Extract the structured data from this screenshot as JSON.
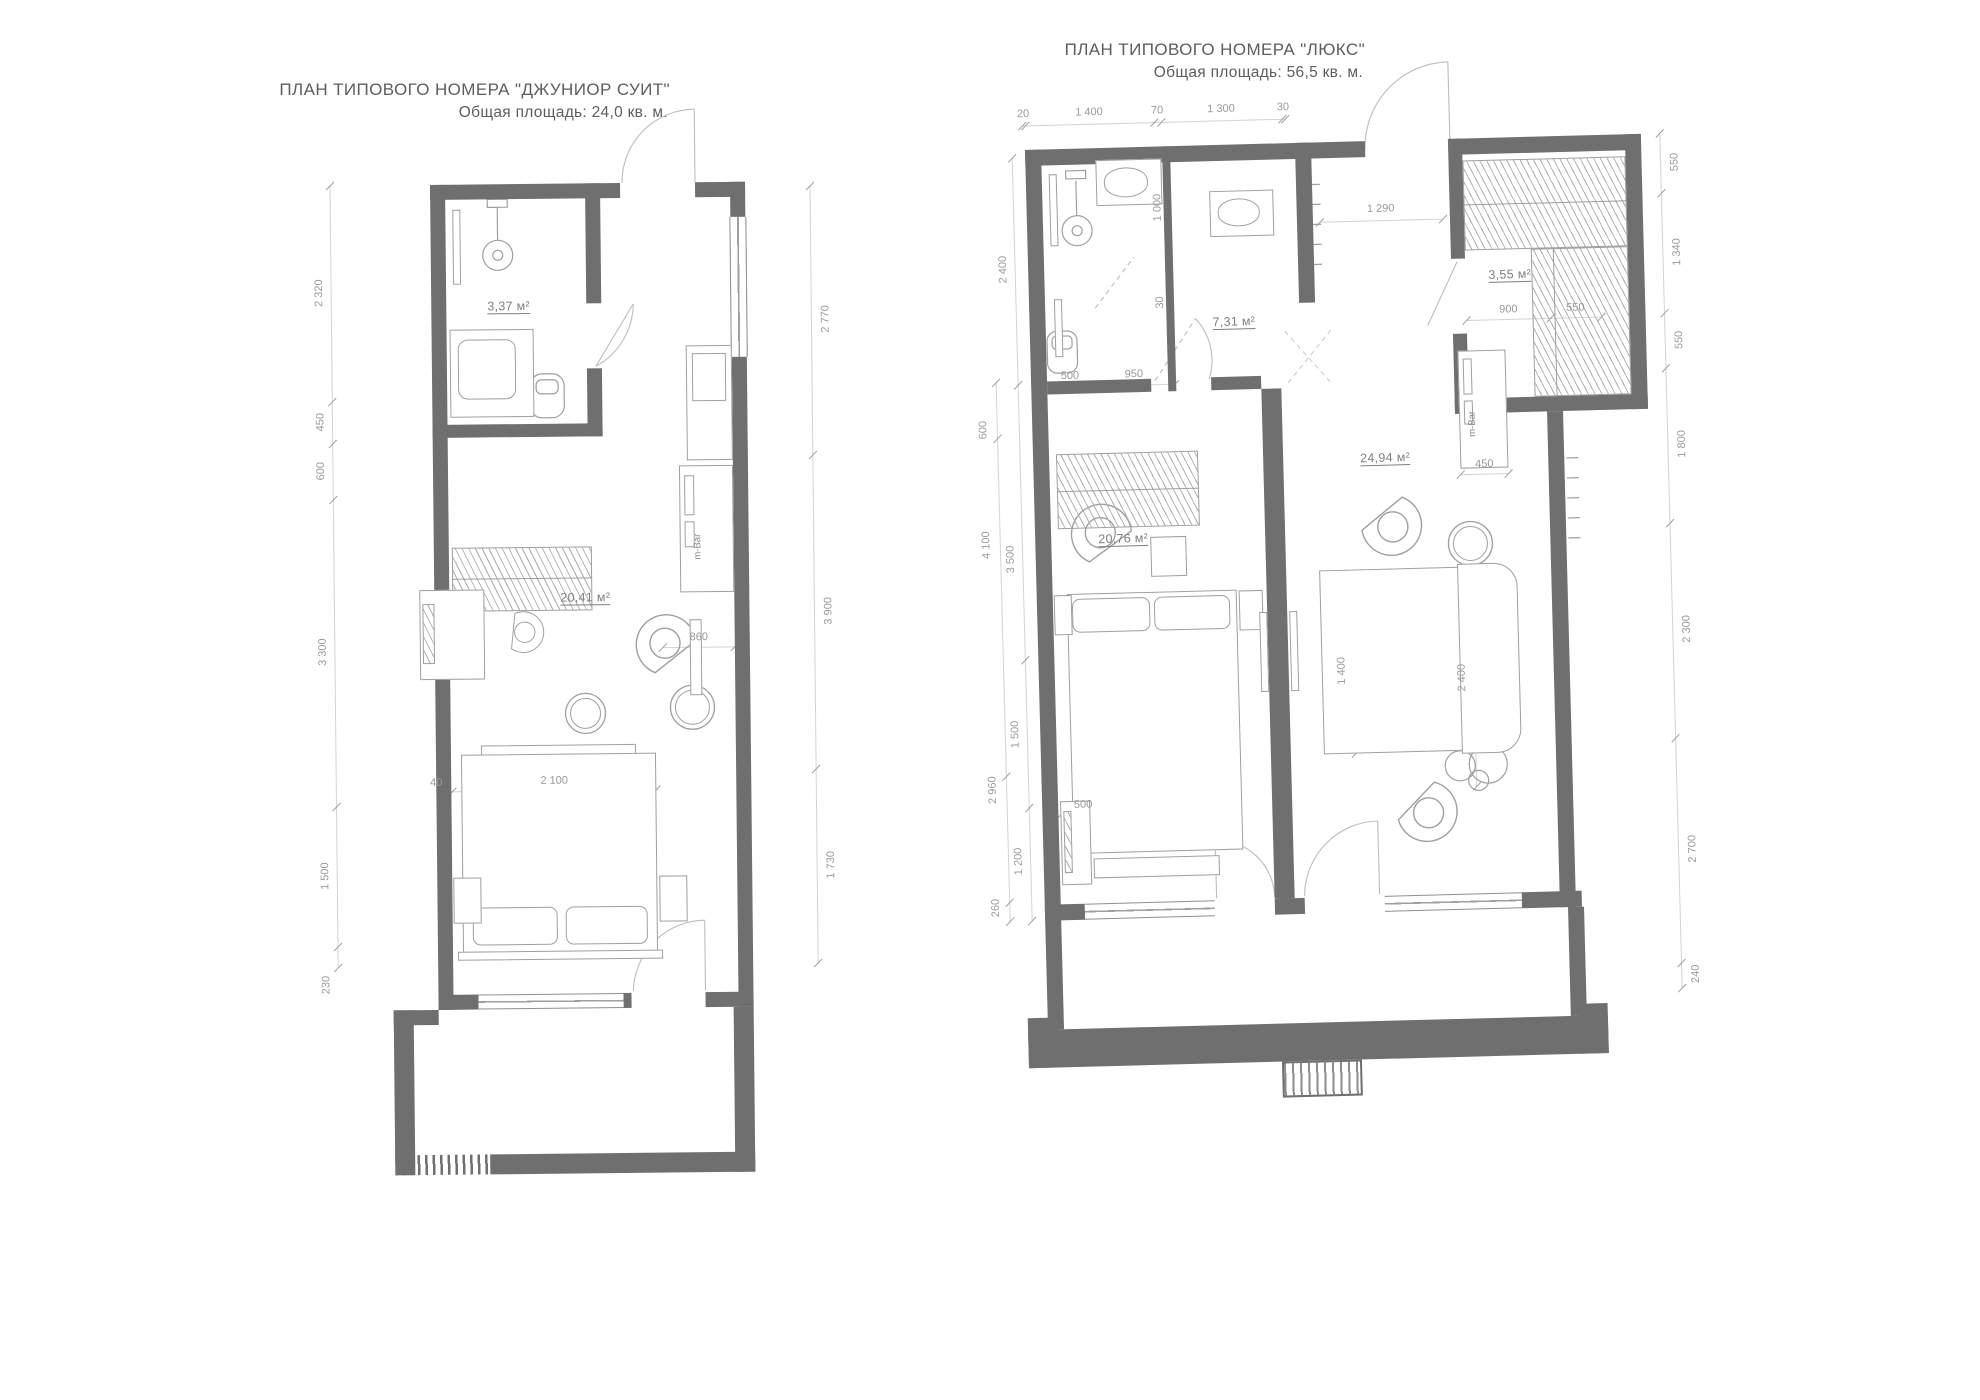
{
  "left_plan": {
    "title": "ПЛАН  ТИПОВОГО НОМЕРА \"ДЖУНИОР СУИТ\"",
    "subtitle": "Общая площадь: 24,0 кв. м.",
    "labels": {
      "bathroom_area": "3,37 м²",
      "room_area": "20,41 м²",
      "minibar": "m-Bar"
    },
    "dims_left": [
      "2 320",
      "450",
      "600",
      "3 300",
      "1 500",
      "230"
    ],
    "dims_right": [
      "2 770",
      "3 900",
      "1 730"
    ],
    "dims_inner": {
      "bed_offset": "40",
      "bed_width": "2 100",
      "tv_gap": "860"
    }
  },
  "right_plan": {
    "title": "ПЛАН  ТИПОВОГО НОМЕРА \"ЛЮКС\"",
    "subtitle": "Общая площадь: 56,5 кв. м.",
    "labels": {
      "bathroom_area": "7,31 м²",
      "wardrobe_area": "3,55 м²",
      "bedroom_area": "20,76 м²",
      "living_area": "24,94 м²",
      "minibar": "m-Bar"
    },
    "dims_top": [
      "20",
      "1 400",
      "70",
      "1 300",
      "30"
    ],
    "dims_left_outer": [
      "600",
      "4 100",
      "2 960",
      "260"
    ],
    "dims_left_inner": [
      "2 400",
      "3 500",
      "1 500",
      "1 200"
    ],
    "dims_right": [
      "550",
      "1 340",
      "550",
      "1 800",
      "2 300",
      "2 700",
      "240"
    ],
    "dims_inner": {
      "hall_width": "1 290",
      "toilet_1": "500",
      "toilet_2": "950",
      "shower_door": "1 000",
      "shower_gap": "30",
      "wardrobe_w": "900",
      "wardrobe_d": "550",
      "minibar_w": "450",
      "sofa_w": "1 400",
      "living_w": "2 400",
      "desk_w": "500"
    }
  },
  "colors": {
    "wall": "#6f6f6f",
    "furniture_line": "#9f9f9f",
    "dim_text": "#9a9a9a",
    "title_text": "#5d5d5d"
  }
}
